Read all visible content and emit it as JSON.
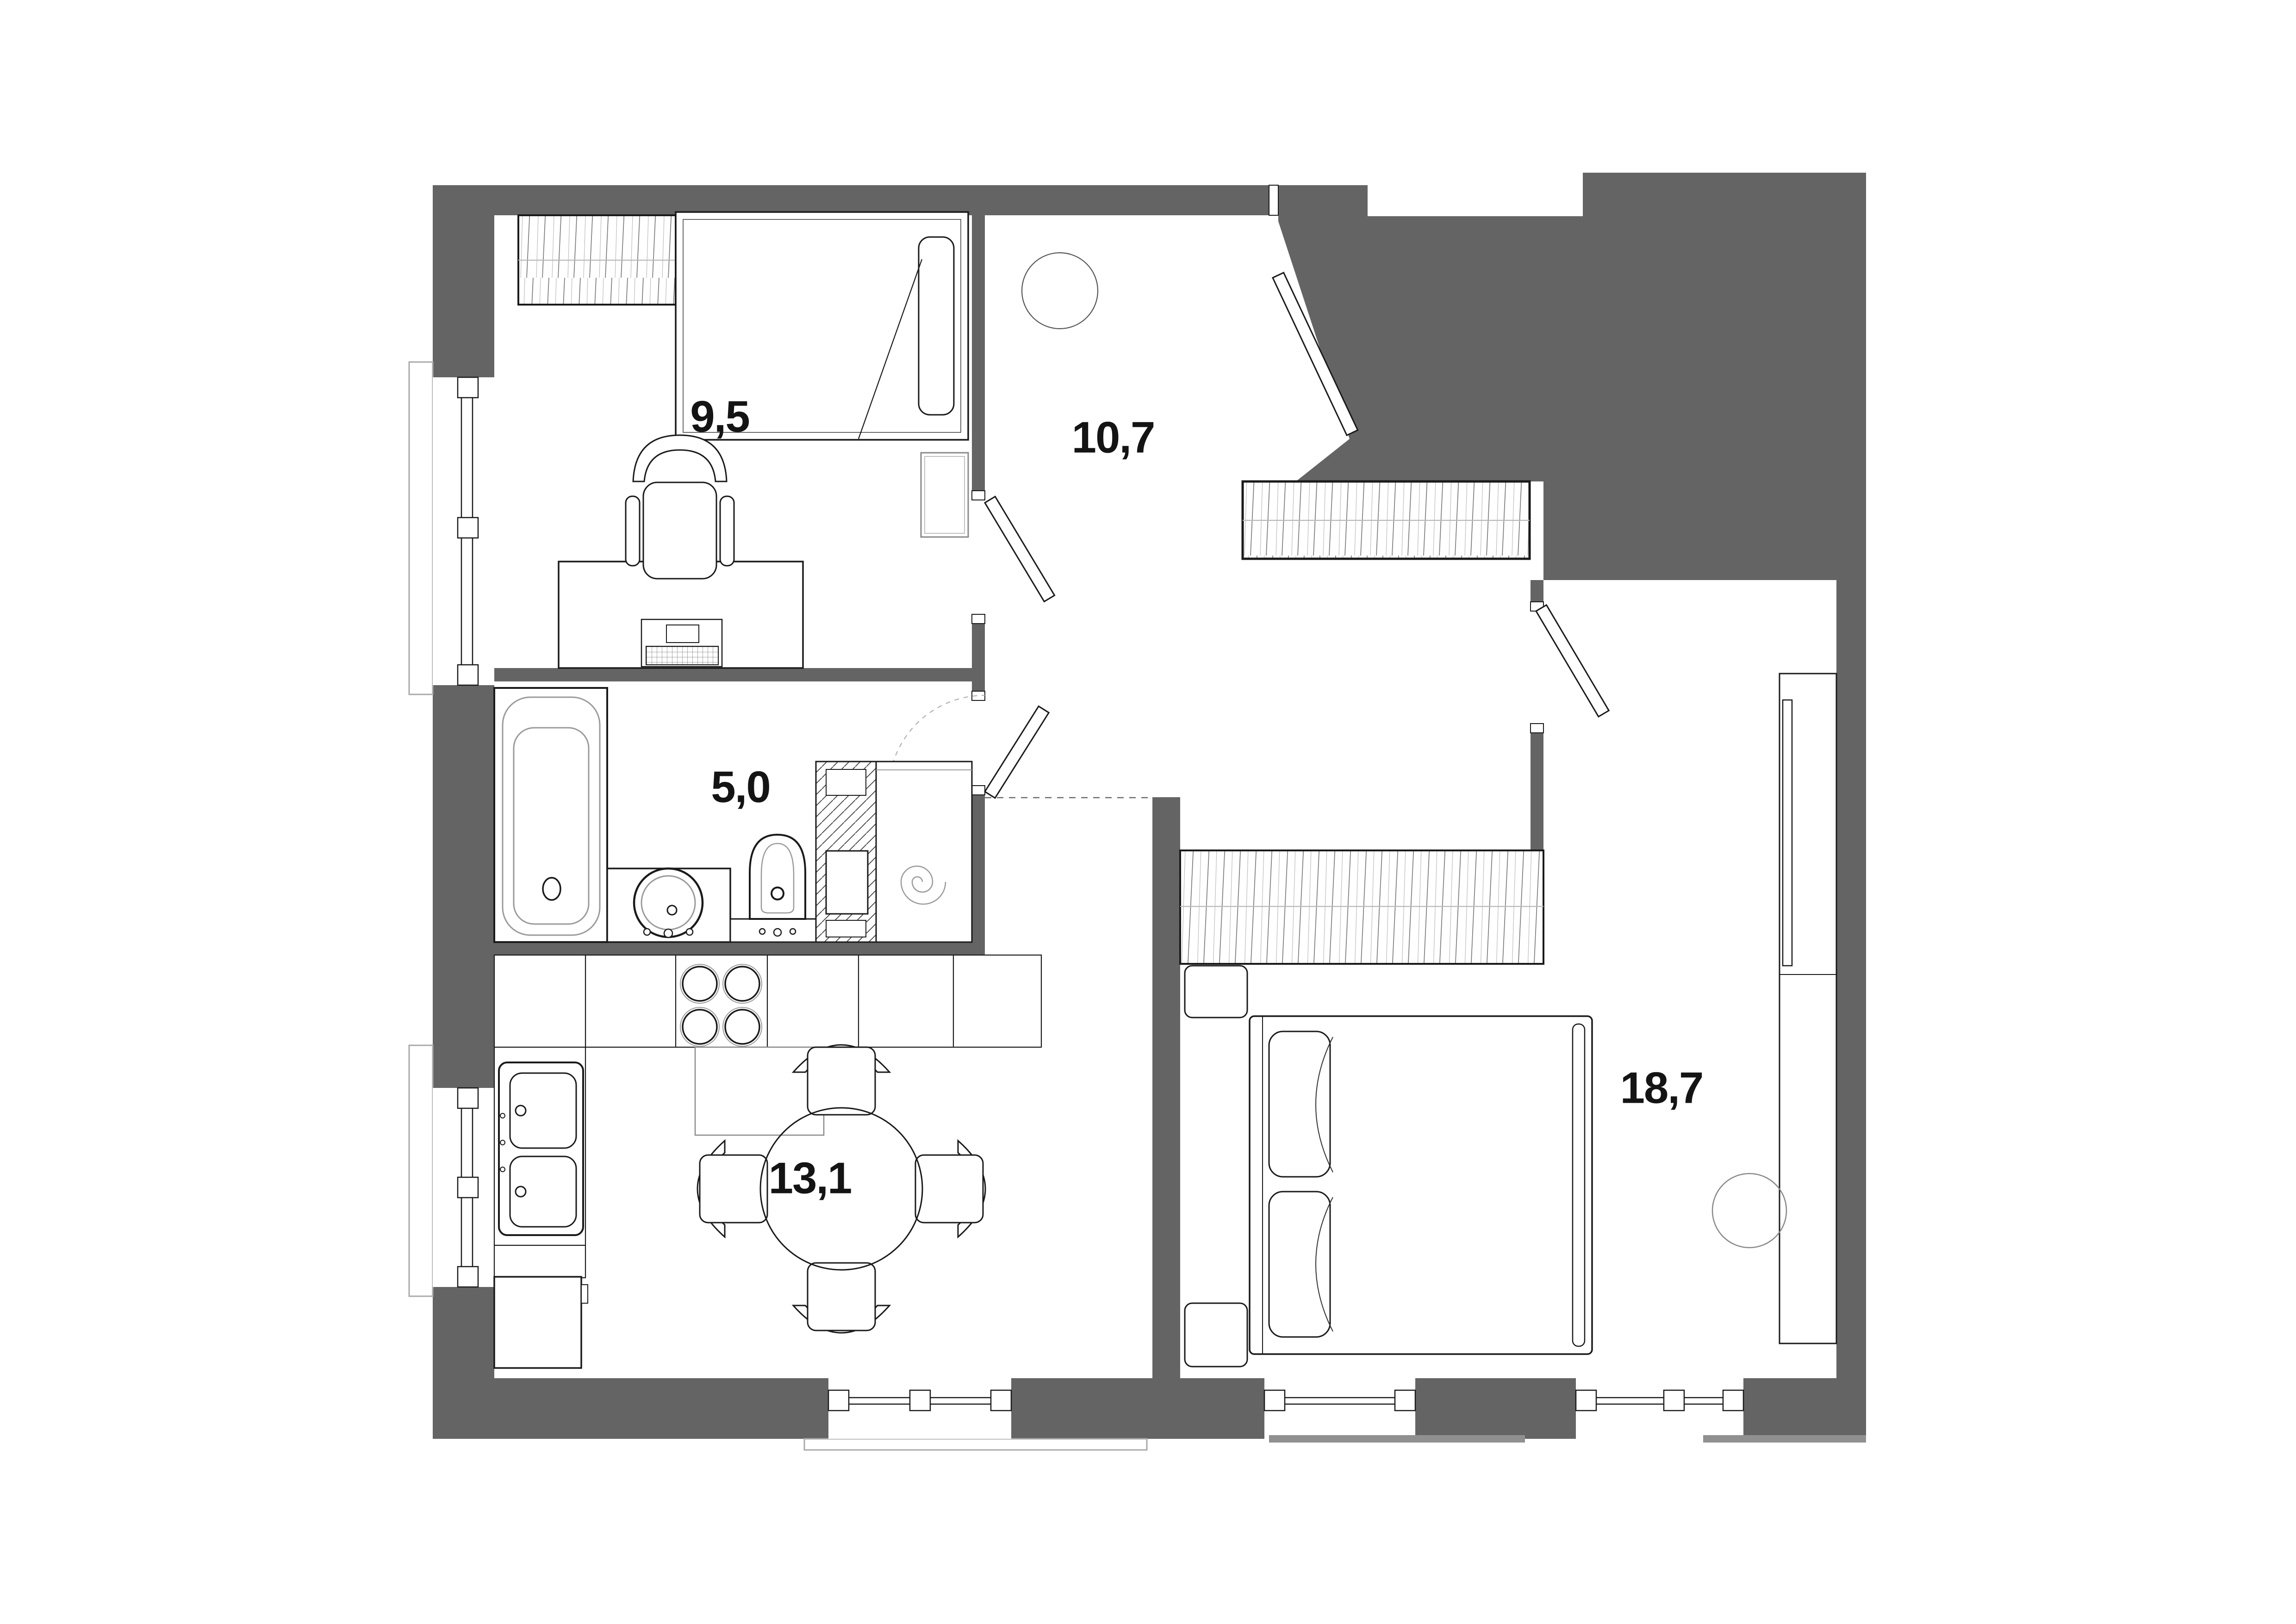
{
  "plan": {
    "type": "apartment-floor-plan",
    "colors": {
      "wall": "#646464",
      "line": "#1a1a1a",
      "fixture_gray": "#9a9a9a",
      "light_gray": "#b8b8b8",
      "slab_gray": "#909090",
      "background": "#ffffff",
      "label": "#141414"
    },
    "rooms": [
      {
        "id": "bedroom-small",
        "area": "9,5"
      },
      {
        "id": "hallway",
        "area": "10,7"
      },
      {
        "id": "bathroom",
        "area": "5,0"
      },
      {
        "id": "kitchen-dining",
        "area": "13,1"
      },
      {
        "id": "bedroom-master",
        "area": "18,7"
      }
    ],
    "furniture": {
      "bedroom_small": [
        "wardrobe-hatched",
        "single-bed-with-pillow",
        "bedside-cabinet",
        "desk",
        "laptop",
        "office-chair",
        "window"
      ],
      "hallway": [
        "ceiling-lamp-circle",
        "entry-door-leaf",
        "built-in-wardrobe-hatched",
        "interior-door-leaves"
      ],
      "bathroom": [
        "bathtub",
        "vanity-with-round-sink",
        "bidet",
        "ventilation-shaft-hatched",
        "washing-machine-spiral",
        "door-swing-arc"
      ],
      "kitchen_dining": [
        "counter-run",
        "double-sink-unit",
        "stove-4-burners",
        "oven-block",
        "tall-cabinet",
        "round-dining-table",
        "four-chairs",
        "window"
      ],
      "bedroom_master": [
        "wardrobe-hatched",
        "double-bed-two-pillows",
        "bedside-table-top",
        "bedside-table-bottom",
        "tv-console",
        "tv-panel",
        "round-pouf",
        "two-windows",
        "entry-door-leaf"
      ]
    }
  }
}
